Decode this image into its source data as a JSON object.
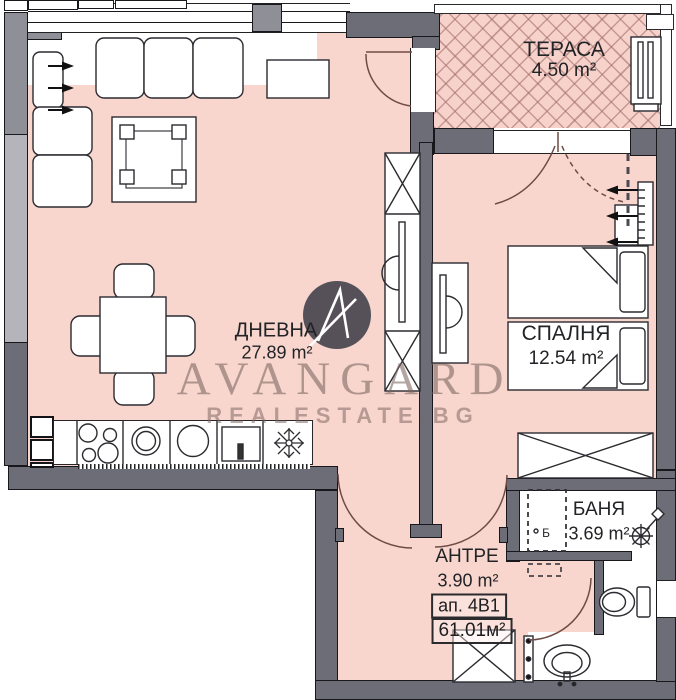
{
  "title": "Apartment floor plan",
  "watermark": {
    "brand": "AVANGARD",
    "site": "REALESTATE.BG"
  },
  "apartment": {
    "label": "ап. 4В1",
    "total_area": "61.01м²"
  },
  "rooms": {
    "terrace": {
      "name": "ТЕРАСА",
      "area": "4.50 m²"
    },
    "living": {
      "name": "ДНЕВНА",
      "area": "27.89 m²"
    },
    "bedroom": {
      "name": "СПАЛНЯ",
      "area": "12.54 m²"
    },
    "bathroom": {
      "name": "БАНЯ",
      "area": "3.69 m²",
      "marker": "Б"
    },
    "hall": {
      "name": "АНТРЕ",
      "area": "3.90 m²"
    }
  },
  "colors": {
    "floor_pink": "#f8d6ce",
    "terrace_hatch": "#a86f63",
    "wall_dark": "#6d6d78",
    "wall_medium": "#8f8f97",
    "wall_light": "#b4b4ba",
    "label_ink": "#222326",
    "watermark": "#7a6460",
    "logo_bg": "#3f3f48"
  }
}
